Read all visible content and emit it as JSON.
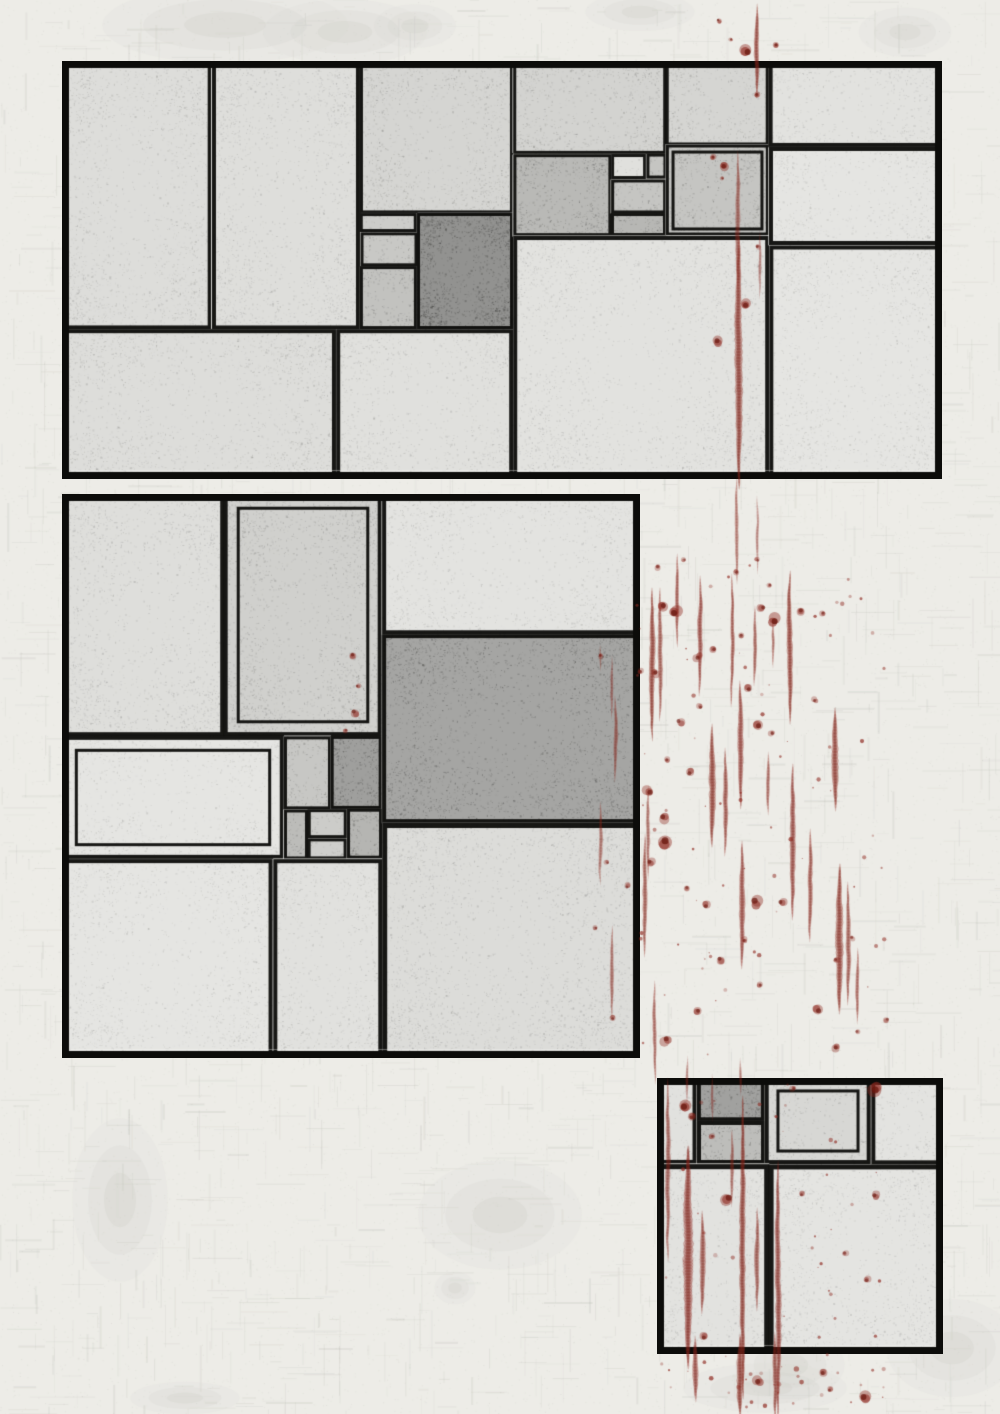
{
  "artwork": {
    "title": "Abstract ink panel composition with red paint drips",
    "canvas": {
      "width": 1000,
      "height": 1414
    },
    "colors": {
      "paper": "#edece7",
      "texture": "#c7cbc0",
      "ink": "#0c0c0a",
      "cell_light": "#f0efea",
      "charcoal": "#2a2a28",
      "blood": "#8f2a21",
      "blood_dark": "#69170f",
      "blotch": "#cbcdc4"
    },
    "paper_texture": {
      "seed": 2,
      "weave_lines": 2600,
      "speckles": 14000
    },
    "panels": [
      {
        "id": "top",
        "x": 62,
        "y": 61,
        "w": 880,
        "h": 418,
        "border": 7,
        "seed": 11,
        "max_depth": 8,
        "hotspot": {
          "x": 0.46,
          "y": 0.4,
          "r": 0.6,
          "strength": 1.0
        }
      },
      {
        "id": "middle",
        "x": 62,
        "y": 494,
        "w": 578,
        "h": 564,
        "border": 7,
        "seed": 23,
        "max_depth": 8,
        "hotspot": {
          "x": 0.52,
          "y": 0.44,
          "r": 0.52,
          "strength": 0.95
        }
      },
      {
        "id": "bottom-right",
        "x": 657,
        "y": 1078,
        "w": 286,
        "h": 276,
        "border": 7,
        "seed": 37,
        "max_depth": 7,
        "hotspot": {
          "x": 0.24,
          "y": 0.24,
          "r": 0.75,
          "strength": 0.85
        }
      }
    ],
    "blotches": [
      [
        225,
        25,
        90,
        28
      ],
      [
        345,
        32,
        60,
        24
      ],
      [
        415,
        26,
        30,
        16
      ],
      [
        640,
        12,
        40,
        14
      ],
      [
        905,
        32,
        34,
        18
      ],
      [
        500,
        1215,
        60,
        40
      ],
      [
        455,
        1288,
        15,
        12
      ],
      [
        765,
        1388,
        60,
        18
      ],
      [
        790,
        1365,
        40,
        25
      ],
      [
        952,
        1348,
        48,
        36
      ],
      [
        120,
        1200,
        35,
        60
      ],
      [
        185,
        1398,
        40,
        12
      ]
    ],
    "blood": {
      "seed": 5,
      "streaks": [
        [
          757,
          8,
          86,
          5,
          0.85
        ],
        [
          738,
          155,
          130,
          5,
          0.6
        ],
        [
          739,
          240,
          245,
          8,
          0.85
        ],
        [
          737,
          480,
          100,
          4,
          0.55
        ],
        [
          760,
          235,
          60,
          3,
          0.5
        ],
        [
          757,
          500,
          70,
          3,
          0.5
        ],
        [
          652,
          592,
          145,
          6,
          0.85
        ],
        [
          660,
          592,
          125,
          5,
          0.7
        ],
        [
          677,
          558,
          85,
          4,
          0.75
        ],
        [
          700,
          580,
          112,
          5,
          0.8
        ],
        [
          732,
          578,
          125,
          4,
          0.75
        ],
        [
          755,
          610,
          72,
          4,
          0.7
        ],
        [
          790,
          575,
          145,
          6,
          0.85
        ],
        [
          773,
          622,
          42,
          3,
          0.6
        ],
        [
          740,
          685,
          120,
          6,
          0.8
        ],
        [
          712,
          728,
          115,
          7,
          0.85
        ],
        [
          725,
          752,
          100,
          5,
          0.75
        ],
        [
          768,
          756,
          55,
          4,
          0.65
        ],
        [
          835,
          712,
          95,
          7,
          0.85
        ],
        [
          648,
          790,
          85,
          4,
          0.6
        ],
        [
          793,
          768,
          148,
          6,
          0.8
        ],
        [
          810,
          833,
          105,
          5,
          0.75
        ],
        [
          742,
          845,
          120,
          6,
          0.8
        ],
        [
          840,
          868,
          142,
          8,
          0.85
        ],
        [
          848,
          886,
          115,
          5,
          0.7
        ],
        [
          858,
          952,
          68,
          4,
          0.65
        ],
        [
          612,
          660,
          55,
          3,
          0.5
        ],
        [
          600,
          648,
          20,
          2,
          0.45
        ],
        [
          615,
          700,
          78,
          4,
          0.6
        ],
        [
          612,
          930,
          85,
          4,
          0.6
        ],
        [
          600,
          806,
          75,
          4,
          0.55
        ],
        [
          645,
          838,
          115,
          5,
          0.7
        ],
        [
          655,
          985,
          95,
          4,
          0.65
        ],
        [
          688,
          1060,
          40,
          3,
          0.5
        ],
        [
          740,
          1062,
          30,
          3,
          0.5
        ],
        [
          688,
          1150,
          215,
          10,
          0.9
        ],
        [
          702,
          1215,
          95,
          6,
          0.75
        ],
        [
          743,
          1100,
          295,
          6,
          0.85
        ],
        [
          757,
          1212,
          95,
          5,
          0.7
        ],
        [
          778,
          1165,
          250,
          6,
          0.8
        ],
        [
          732,
          1133,
          70,
          4,
          0.6
        ],
        [
          668,
          1082,
          175,
          5,
          0.65
        ],
        [
          712,
          1078,
          40,
          3,
          0.5
        ],
        [
          695,
          1340,
          58,
          6,
          0.8
        ],
        [
          740,
          1338,
          76,
          7,
          0.85
        ],
        [
          775,
          1336,
          80,
          5,
          0.75
        ]
      ],
      "drops": [
        [
          746,
          52,
          6,
          0.85
        ],
        [
          719,
          21,
          2.5,
          0.7
        ],
        [
          731,
          40,
          2,
          0.6
        ],
        [
          777,
          45,
          3,
          0.75
        ],
        [
          713,
          157,
          3,
          0.7
        ],
        [
          725,
          165,
          4.5,
          0.8
        ],
        [
          722,
          178,
          2,
          0.6
        ],
        [
          758,
          247,
          2.5,
          0.65
        ],
        [
          747,
          305,
          5,
          0.8
        ],
        [
          717,
          342,
          5,
          0.8
        ],
        [
          757,
          95,
          3,
          0.7
        ],
        [
          663,
          607,
          5,
          0.8
        ],
        [
          676,
          611,
          6,
          0.85
        ],
        [
          655,
          673,
          4,
          0.7
        ],
        [
          698,
          657,
          4,
          0.7
        ],
        [
          640,
          672,
          3,
          0.6
        ],
        [
          713,
          650,
          3.5,
          0.65
        ],
        [
          742,
          636,
          3,
          0.6
        ],
        [
          762,
          607,
          4,
          0.7
        ],
        [
          775,
          620,
          6,
          0.85
        ],
        [
          800,
          611,
          4,
          0.7
        ],
        [
          823,
          614,
          3,
          0.6
        ],
        [
          748,
          688,
          4,
          0.7
        ],
        [
          700,
          707,
          3,
          0.6
        ],
        [
          680,
          722,
          4,
          0.65
        ],
        [
          759,
          724,
          5,
          0.75
        ],
        [
          772,
          733,
          3,
          0.6
        ],
        [
          815,
          700,
          3,
          0.6
        ],
        [
          667,
          760,
          3,
          0.6
        ],
        [
          690,
          772,
          4,
          0.7
        ],
        [
          648,
          792,
          5,
          0.75
        ],
        [
          663,
          818,
          5,
          0.75
        ],
        [
          667,
          843,
          7,
          0.85
        ],
        [
          651,
          862,
          4,
          0.7
        ],
        [
          686,
          888,
          3,
          0.6
        ],
        [
          706,
          905,
          4,
          0.7
        ],
        [
          756,
          903,
          6,
          0.8
        ],
        [
          782,
          903,
          4,
          0.7
        ],
        [
          745,
          940,
          3,
          0.6
        ],
        [
          721,
          960,
          4,
          0.7
        ],
        [
          760,
          985,
          3,
          0.6
        ],
        [
          697,
          1012,
          4,
          0.7
        ],
        [
          666,
          1040,
          5,
          0.75
        ],
        [
          817,
          1010,
          5,
          0.75
        ],
        [
          836,
          1048,
          4,
          0.7
        ],
        [
          875,
          1088,
          7,
          0.85
        ],
        [
          728,
          1198,
          6,
          0.8
        ],
        [
          875,
          1196,
          4,
          0.7
        ],
        [
          802,
          1194,
          3,
          0.6
        ],
        [
          867,
          1280,
          3.5,
          0.6
        ],
        [
          823,
          1372,
          4,
          0.7
        ],
        [
          758,
          1382,
          5,
          0.75
        ],
        [
          703,
          1336,
          4,
          0.7
        ],
        [
          864,
          1398,
          6,
          0.8
        ],
        [
          830,
          1390,
          3,
          0.6
        ],
        [
          683,
          1106,
          6,
          0.85
        ],
        [
          692,
          1116,
          4,
          0.7
        ],
        [
          712,
          1136,
          3,
          0.6
        ],
        [
          793,
          1088,
          3,
          0.6
        ],
        [
          845,
          1254,
          3,
          0.55
        ],
        [
          352,
          655,
          3.5,
          0.7
        ],
        [
          358,
          686,
          2.5,
          0.6
        ],
        [
          355,
          713,
          4,
          0.7
        ],
        [
          346,
          730,
          2.5,
          0.6
        ],
        [
          601,
          656,
          2.5,
          0.6
        ],
        [
          627,
          886,
          3,
          0.6
        ],
        [
          607,
          862,
          2.5,
          0.55
        ],
        [
          596,
          928,
          2.5,
          0.55
        ],
        [
          612,
          1018,
          3,
          0.6
        ],
        [
          836,
          960,
          3,
          0.6
        ],
        [
          852,
          938,
          2.5,
          0.55
        ],
        [
          737,
          572,
          3,
          0.6
        ],
        [
          757,
          560,
          2.5,
          0.55
        ],
        [
          770,
          585,
          2.5,
          0.55
        ],
        [
          658,
          567,
          3,
          0.6
        ],
        [
          684,
          560,
          2.5,
          0.5
        ],
        [
          887,
          1020,
          3,
          0.55
        ],
        [
          857,
          1032,
          2.5,
          0.5
        ]
      ],
      "spray": [
        {
          "seed": 91,
          "x": 636,
          "y": 556,
          "w": 250,
          "h": 500,
          "count": 70,
          "rmax": 1.8
        },
        {
          "seed": 92,
          "x": 655,
          "y": 1080,
          "w": 230,
          "h": 330,
          "count": 45,
          "rmax": 1.8
        },
        {
          "seed": 93,
          "x": 690,
          "y": 1350,
          "w": 200,
          "h": 60,
          "count": 18,
          "rmax": 2.2
        }
      ]
    }
  }
}
